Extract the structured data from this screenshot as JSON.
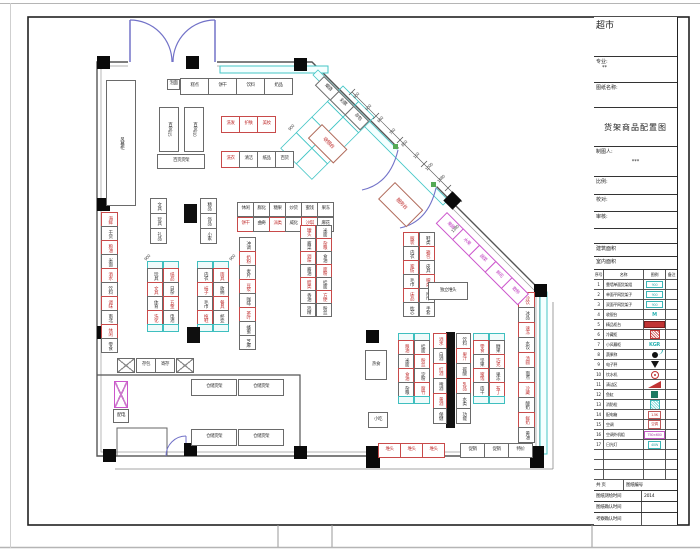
{
  "titleblock": {
    "project": "超市",
    "field_major": "专业:",
    "major_value": "**",
    "field_drawing_name": "图纸名称:",
    "drawing_title": "货架商品配置图",
    "field_draftsman": "制图人:",
    "draftsman_value": "***",
    "field_scale": "比例:",
    "field_check": "校对:",
    "field_audit": "审核:",
    "field_building_area": "建筑面积",
    "field_indoor_area": "室内面积",
    "field_pages": "共  页",
    "field_drawing_no": "图纸编号",
    "legend": {
      "headers": [
        "序号",
        "名称",
        "图例",
        "备注"
      ],
      "rows": [
        {
          "no": "1",
          "name": "靠墙单面货架组",
          "sym": "cyanrect",
          "symtext": "900"
        },
        {
          "no": "2",
          "name": "单面平网货架子",
          "sym": "cyanrect",
          "symtext": "900"
        },
        {
          "no": "3",
          "name": "双面平网货架子",
          "sym": "cyanrect",
          "symtext": "900"
        },
        {
          "no": "4",
          "name": "收银台",
          "sym": "cyantext",
          "symtext": "M"
        },
        {
          "no": "5",
          "name": "精品柜台",
          "sym": "redbar",
          "symtext": ""
        },
        {
          "no": "6",
          "name": "冷藏柜",
          "sym": "redhatch",
          "symtext": ""
        },
        {
          "no": "7",
          "name": "小风幕柜",
          "sym": "cyantext",
          "symtext": "KGR"
        },
        {
          "no": "8",
          "name": "蔬果称",
          "sym": "blackdot",
          "symtext": ""
        },
        {
          "no": "9",
          "name": "电子秤",
          "sym": "lamp",
          "symtext": ""
        },
        {
          "no": "10",
          "name": "饮水机",
          "sym": "redcircle",
          "symtext": ""
        },
        {
          "no": "11",
          "name": "清洁区",
          "sym": "redwedge",
          "symtext": ""
        },
        {
          "no": "12",
          "name": "鱼缸",
          "sym": "tealbox",
          "symtext": ""
        },
        {
          "no": "13",
          "name": "消防栓",
          "sym": "cyanhatch",
          "symtext": ""
        },
        {
          "no": "14",
          "name": "配电箱",
          "sym": "redbox",
          "symtext": "1.5K"
        },
        {
          "no": "15",
          "name": "空调",
          "sym": "redbox",
          "symtext": "空调"
        },
        {
          "no": "16",
          "name": "空调外机组",
          "sym": "magbox",
          "symtext": "750×600"
        },
        {
          "no": "17",
          "name": "日光灯",
          "sym": "cyanbox",
          "symtext": "40W"
        },
        {
          "no": "",
          "name": "",
          "sym": "none",
          "symtext": ""
        },
        {
          "no": "",
          "name": "",
          "sym": "none",
          "symtext": ""
        },
        {
          "no": "",
          "name": "",
          "sym": "none",
          "symtext": ""
        }
      ]
    },
    "rows_bottom": [
      {
        "label": "图纸测绘时间",
        "value": "2014"
      },
      {
        "label": "图纸确认时间",
        "value": ""
      },
      {
        "label": "考察确认时间",
        "value": ""
      }
    ]
  },
  "plan": {
    "columns": [
      [
        97,
        56
      ],
      [
        186,
        56
      ],
      [
        294,
        58
      ],
      [
        97,
        198
      ],
      [
        97,
        326
      ],
      [
        103,
        449
      ],
      [
        184,
        443
      ],
      [
        294,
        446
      ],
      [
        366,
        330
      ],
      [
        366,
        446,
        14,
        22
      ],
      [
        530,
        446,
        14,
        22
      ],
      [
        534,
        284
      ],
      [
        446,
        194,
        13,
        13,
        1
      ]
    ],
    "runs": [
      {
        "x": 180,
        "y": 78,
        "d": "h",
        "cw": 29,
        "ch": 17,
        "cells": [
          "糕点",
          "饼干",
          "饮料",
          "奶品"
        ]
      },
      {
        "x": 221,
        "y": 116,
        "d": "h",
        "cw": 19,
        "ch": 17,
        "cells": [
          "!洗发",
          "!护肤",
          "!美妆"
        ]
      },
      {
        "x": 221,
        "y": 151,
        "d": "h",
        "cw": 19,
        "ch": 17,
        "cells": [
          "!洗衣",
          "清洁",
          "纸品",
          "百货"
        ]
      },
      {
        "x": 101,
        "y": 212,
        "d": "v",
        "cw": 17,
        "ch": 15,
        "cells": [
          "!海鲜",
          "干货",
          "!粮油",
          "米面",
          "!酒水",
          "饮料",
          "!调味",
          "南北",
          "!休闲",
          "零食"
        ]
      },
      {
        "x": 150,
        "y": 198,
        "d": "v",
        "cw": 17,
        "ch": 16,
        "cells": [
          "文具",
          "玩具",
          "礼品"
        ]
      },
      {
        "x": 200,
        "y": 198,
        "d": "v",
        "cw": 17,
        "ch": 16,
        "cells": [
          "精品",
          "饰品",
          "小家"
        ]
      },
      {
        "x": 147,
        "y": 261,
        "d": "v",
        "cw": 16,
        "ch": 15,
        "cells": [
          "*",
          "玩具",
          "!文具",
          "体育",
          "!洗化",
          "*"
        ]
      },
      {
        "x": 163,
        "y": 261,
        "d": "v",
        "cw": 16,
        "ch": 15,
        "cells": [
          "*",
          "!纸品",
          "日杂",
          "!五金",
          "电池",
          "*"
        ]
      },
      {
        "x": 197,
        "y": 261,
        "d": "v",
        "cw": 16,
        "ch": 15,
        "cells": [
          "*",
          "内衣",
          "!袜子",
          "毛巾",
          "!拖鞋",
          "*"
        ]
      },
      {
        "x": 213,
        "y": 261,
        "d": "v",
        "cw": 16,
        "ch": 15,
        "cells": [
          "*",
          "!雨具",
          "收纳",
          "!餐具",
          "杯壶",
          "*"
        ]
      },
      {
        "x": 237,
        "y": 202,
        "d": "h",
        "cw": 17,
        "ch": 15,
        "cells": [
          "休闲",
          "膨化",
          "糖果",
          "炒货",
          "蜜饯",
          "果冻"
        ]
      },
      {
        "x": 237,
        "y": 217,
        "d": "h",
        "cw": 17,
        "ch": 15,
        "cells": [
          "!饼干",
          "曲奇",
          "!派类",
          "威化",
          "!沙琪",
          "麻花"
        ]
      },
      {
        "x": 239,
        "y": 237,
        "d": "v",
        "cw": 17,
        "ch": 15,
        "cells": [
          "冲调",
          "!奶粉",
          "麦片",
          "!豆浆",
          "咖啡",
          "!茶叶",
          "蜂蜜",
          "芝麻"
        ]
      },
      {
        "x": 300,
        "y": 225,
        "d": "v",
        "cw": 16,
        "ch": 14,
        "cells": [
          "!罐头",
          "酱菜",
          "!调味",
          "酱油",
          "!醋类",
          "香油",
          "鸡精"
        ]
      },
      {
        "x": 316,
        "y": 225,
        "d": "v",
        "cw": 16,
        "ch": 14,
        "cells": [
          "米面",
          "!杂粮",
          "食油",
          "!面粉",
          "挂面",
          "!方便",
          "粉丝"
        ]
      },
      {
        "x": 403,
        "y": 232,
        "d": "v",
        "cw": 16,
        "ch": 15,
        "cells": [
          "!服装",
          "内衣",
          "!家纺",
          "毛巾",
          "!床品",
          "枕芯"
        ]
      },
      {
        "x": 419,
        "y": 232,
        "d": "v",
        "cw": 16,
        "ch": 15,
        "cells": [
          "鞋类",
          "!箱包",
          "皮具",
          "!帽类",
          "围巾",
          "手套"
        ]
      },
      {
        "x": 398,
        "y": 333,
        "d": "v",
        "cw": 16,
        "ch": 15,
        "cells": [
          "*",
          "!粮油",
          "米面",
          "!食油",
          "杂粮",
          "*"
        ]
      },
      {
        "x": 414,
        "y": 333,
        "d": "v",
        "cw": 16,
        "ch": 15,
        "cells": [
          "*",
          "挂面",
          "!粉丝",
          "淀粉",
          "!腐竹",
          "*"
        ]
      },
      {
        "x": 433,
        "y": 333,
        "d": "v",
        "cw": 14,
        "ch": 16,
        "cells": [
          "!酒水",
          "白酒",
          "!红酒",
          "啤酒",
          "!黄酒",
          "保健"
        ]
      },
      {
        "x": 456,
        "y": 333,
        "d": "v",
        "cw": 15,
        "ch": 16,
        "cells": [
          "饮料",
          "!果汁",
          "碳酸",
          "!乳品",
          "水类",
          "功能"
        ]
      },
      {
        "x": 473,
        "y": 333,
        "d": "v",
        "cw": 16,
        "ch": 15,
        "cells": [
          "*",
          "!零食",
          "坚果",
          "!蜜饯",
          "肉干",
          "*"
        ]
      },
      {
        "x": 489,
        "y": 333,
        "d": "v",
        "cw": 16,
        "ch": 15,
        "cells": [
          "*",
          "糖果",
          "!巧克",
          "果冻",
          "!布丁",
          "*"
        ]
      },
      {
        "x": 518,
        "y": 292,
        "d": "v",
        "cw": 17,
        "ch": 16,
        "cells": [
          "!冷饮",
          "冰品",
          "!速冻",
          "水饺",
          "!汤圆",
          "面点",
          "!冷藏",
          "酸奶",
          "!鲜奶",
          "黄油"
        ]
      },
      {
        "x": 378,
        "y": 443,
        "d": "h",
        "cw": 23,
        "ch": 15,
        "cells": [
          "!堆头",
          "!堆头",
          "!堆头"
        ]
      },
      {
        "x": 460,
        "y": 443,
        "d": "h",
        "cw": 25,
        "ch": 15,
        "cells": [
          "促销",
          "促销",
          "特价"
        ]
      },
      {
        "x": 136,
        "y": 358,
        "d": "h",
        "cw": 20,
        "ch": 15,
        "cells": [
          "存包",
          "寄存"
        ]
      },
      {
        "x": 324,
        "y": 76,
        "d": "h",
        "cw": 22,
        "ch": 13,
        "rot": 45,
        "cells": [
          "烟酒",
          "彩票",
          "存包"
        ]
      },
      {
        "x": 447,
        "y": 212,
        "d": "h",
        "cw": 24,
        "ch": 16,
        "rot": 45,
        "cells": [
          "~果蔬",
          "~水果",
          "~蔬菜",
          "~鲜花",
          "~散称"
        ]
      }
    ],
    "boxes": [
      {
        "x": 106,
        "y": 80,
        "w": 30,
        "h": 126,
        "t": "风幕柜",
        "cls": "vert",
        "name": "air-curtain-cabinet"
      },
      {
        "x": 167,
        "y": 79,
        "w": 13,
        "h": 11,
        "t": "泡面",
        "cls": "",
        "name": "shelf-box"
      },
      {
        "x": 159,
        "y": 107,
        "w": 20,
        "h": 45,
        "t": "百货",
        "sub": "915",
        "cls": "vert",
        "name": "shelf-box"
      },
      {
        "x": 184,
        "y": 107,
        "w": 20,
        "h": 45,
        "t": "百货",
        "sub": "910",
        "cls": "vert",
        "name": "shelf-box"
      },
      {
        "x": 157,
        "y": 154,
        "w": 48,
        "h": 15,
        "t": "百货货架",
        "cls": "",
        "name": "shelf-box"
      },
      {
        "x": 184,
        "y": 204,
        "w": 13,
        "h": 19,
        "t": "",
        "cls": "solid",
        "name": "counter-block"
      },
      {
        "x": 187,
        "y": 327,
        "w": 13,
        "h": 16,
        "t": "",
        "cls": "solid",
        "name": "counter-block"
      },
      {
        "x": 428,
        "y": 282,
        "w": 40,
        "h": 18,
        "t": "独立堆头",
        "cls": "",
        "name": "promo-island"
      },
      {
        "x": 365,
        "y": 350,
        "w": 22,
        "h": 30,
        "t": "热食",
        "cls": "",
        "name": "shelf-box"
      },
      {
        "x": 368,
        "y": 412,
        "w": 20,
        "h": 16,
        "t": "小吃",
        "cls": "",
        "name": "shelf-box"
      },
      {
        "x": 191,
        "y": 379,
        "w": 46,
        "h": 17,
        "t": "仓储货架",
        "cls": "",
        "name": "storage-rack"
      },
      {
        "x": 238,
        "y": 379,
        "w": 46,
        "h": 17,
        "t": "仓储货架",
        "cls": "",
        "name": "storage-rack"
      },
      {
        "x": 191,
        "y": 429,
        "w": 46,
        "h": 17,
        "t": "仓储货架",
        "cls": "",
        "name": "storage-rack"
      },
      {
        "x": 238,
        "y": 429,
        "w": 46,
        "h": 17,
        "t": "仓储货架",
        "cls": "",
        "name": "storage-rack"
      },
      {
        "x": 117,
        "y": 358,
        "w": 18,
        "h": 15,
        "t": "",
        "cls": "xbox",
        "name": "crossed-fixture"
      },
      {
        "x": 176,
        "y": 358,
        "w": 18,
        "h": 15,
        "t": "",
        "cls": "xbox",
        "name": "crossed-fixture"
      },
      {
        "x": 114,
        "y": 381,
        "w": 14,
        "h": 27,
        "t": "",
        "cls": "xpink",
        "name": "stair-block"
      },
      {
        "x": 113,
        "y": 409,
        "w": 16,
        "h": 14,
        "t": "配电",
        "cls": "",
        "name": "power-box"
      },
      {
        "x": 322,
        "y": 124,
        "w": 36,
        "h": 20,
        "t": "收银台",
        "cls": "redtext",
        "rot": 45,
        "name": "cashier-desk"
      },
      {
        "x": 395,
        "y": 182,
        "w": 40,
        "h": 24,
        "t": "服务台",
        "cls": "redtext",
        "rot": 45,
        "name": "service-desk"
      }
    ],
    "dims": [
      {
        "x": 352,
        "y": 96,
        "t": "600"
      },
      {
        "x": 364,
        "y": 108,
        "t": "600"
      },
      {
        "x": 376,
        "y": 120,
        "t": "640"
      },
      {
        "x": 388,
        "y": 132,
        "t": "740"
      },
      {
        "x": 400,
        "y": 144,
        "t": "850"
      },
      {
        "x": 412,
        "y": 156,
        "t": "150"
      },
      {
        "x": 424,
        "y": 168,
        "t": "1000"
      },
      {
        "x": 436,
        "y": 180,
        "t": "1480"
      },
      {
        "x": 450,
        "y": 230,
        "t": "1380"
      },
      {
        "x": 143,
        "y": 258,
        "t": "900"
      },
      {
        "x": 228,
        "y": 258,
        "t": "900"
      },
      {
        "x": 287,
        "y": 128,
        "t": "900"
      }
    ]
  }
}
